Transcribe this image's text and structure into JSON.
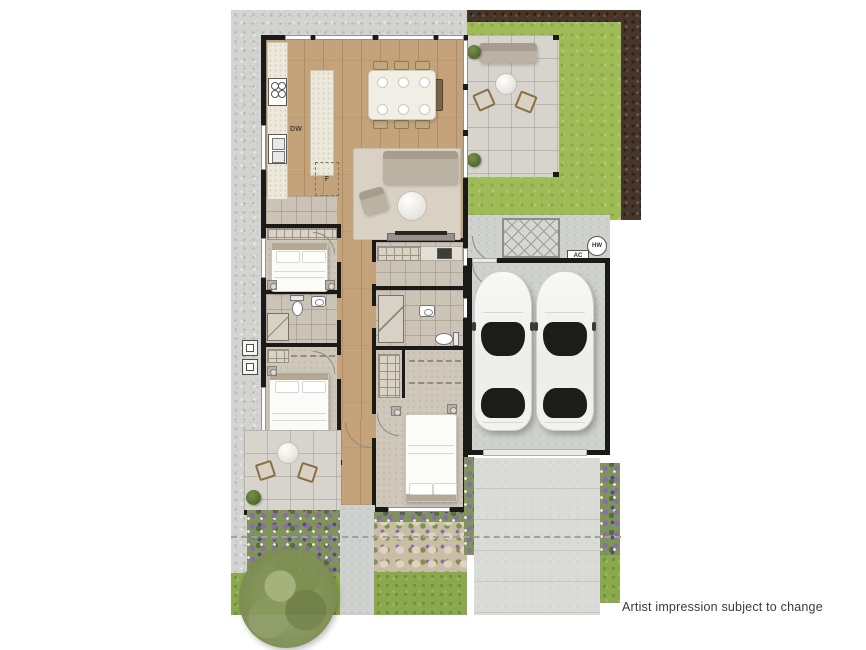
{
  "disclaimer": {
    "text": "Artist impression subject to change"
  },
  "labels": {
    "dishwasher": "DW",
    "fridge": "F",
    "air_conditioner": "AC",
    "hot_water": "HW"
  },
  "palette": {
    "background": "#ffffff",
    "wall": "#1a1a18",
    "timber": "#c5a37a",
    "carpet": "#cfc8ba",
    "tile": "#cbc3b6",
    "gravel": "#d3d3d1",
    "grass": "#9fbb58",
    "front_grass": "#8aa84c",
    "mulch": "#47362a",
    "paving": "#d7d4cd",
    "concrete": "#cfd1ce",
    "driveway": "#dadbd6",
    "flower_purple": "#8d6bab",
    "rug": "#d9d2c4",
    "car_glass": "#1c1c1a",
    "text": "#3b3b3b"
  },
  "icons": {
    "cooktop": "cooktop-icon",
    "kitchen_sink": "sink-icon",
    "toilet": "toilet-icon",
    "basin": "basin-icon",
    "shower": "shower-icon",
    "bed": "bed-icon",
    "sofa": "sofa-icon",
    "dining_table": "dining-table-icon",
    "car": "car-icon",
    "tree": "tree-icon",
    "clothesline": "clothesline-icon"
  }
}
